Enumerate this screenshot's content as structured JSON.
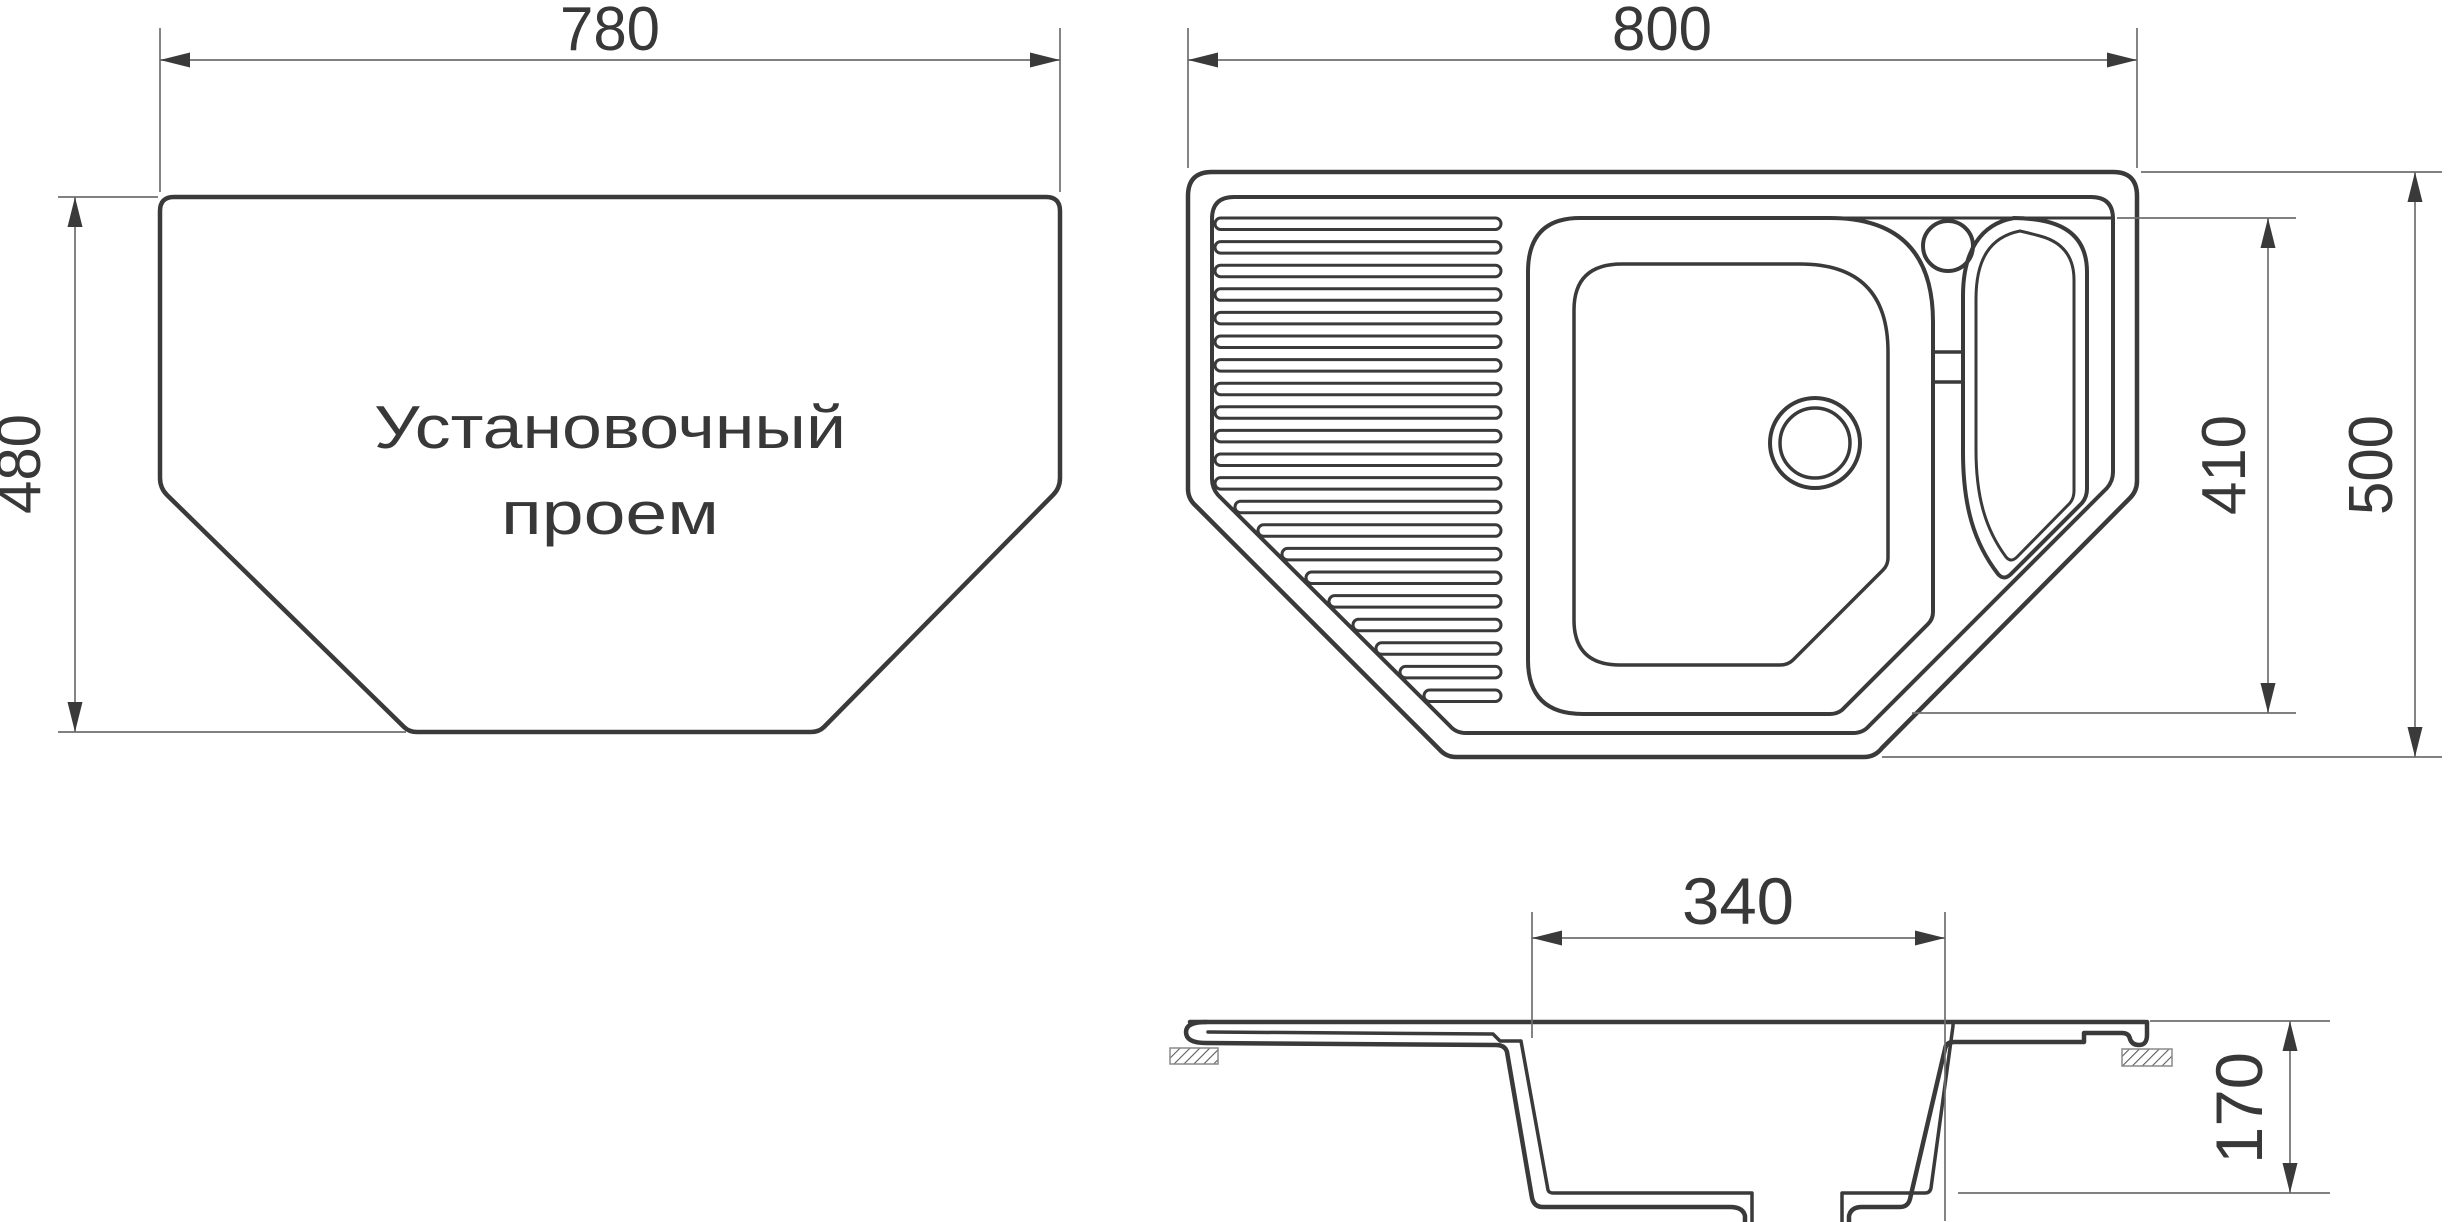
{
  "canvas": {
    "width": 2454,
    "height": 1222,
    "bg": "#ffffff"
  },
  "styles": {
    "line_color": "#3a3a3a",
    "thin_color": "#6f6f6f",
    "text_color": "#383838",
    "hatch_color": "#5c5c5c",
    "hatch_border": "#8a8a8a",
    "stroke_outer": 4.5,
    "stroke_inner": 3.5,
    "stroke_thin": 1.7
  },
  "views": {
    "opening_view": {
      "title_label": {
        "lines": [
          "Установочный",
          "проем"
        ],
        "x": 610,
        "ys": [
          448,
          534
        ],
        "font": 60,
        "text_lengths": [
          472,
          218
        ]
      },
      "elements": [
        {
          "kind": "path",
          "name": "opening-outline",
          "w": 4.5,
          "d": "M 174 197 L 1046 197 Q 1060 197 1060 211 L 1060 478 Q 1060 488 1053 495 L 824 727 Q 819 732 811 732 L 417 732 Q 409 732 404 727 L 167 495 Q 160 488 160 478 L 160 211 Q 160 197 174 197 Z"
        }
      ],
      "dimensions": [
        {
          "name": "dim-780",
          "value": "780",
          "font": 62,
          "text_length": 100,
          "text": {
            "x": 610,
            "y": 50
          },
          "line": [
            160,
            60,
            1060,
            60
          ],
          "ext": [
            [
              160,
              28,
              160,
              192
            ],
            [
              1060,
              28,
              1060,
              192
            ]
          ],
          "arrows": [
            {
              "x": 160,
              "y": 60,
              "dir": "left"
            },
            {
              "x": 1060,
              "y": 60,
              "dir": "right"
            }
          ]
        },
        {
          "name": "dim-480",
          "value": "480",
          "font": 62,
          "text_length": 100,
          "rotate": -90,
          "text": {
            "x": 40,
            "y": 464
          },
          "line": [
            75,
            197,
            75,
            732
          ],
          "ext": [
            [
              58,
              197,
              158,
              197
            ],
            [
              58,
              732,
              406,
              732
            ]
          ],
          "arrows": [
            {
              "x": 75,
              "y": 197,
              "dir": "up"
            },
            {
              "x": 75,
              "y": 732,
              "dir": "down"
            }
          ]
        }
      ]
    },
    "sink_top_view": {
      "elements": [
        {
          "kind": "path",
          "name": "sink-outer-outline",
          "w": 4.5,
          "d": "M 1212 172 L 2113 172 Q 2137 172 2137 196 L 2137 481 Q 2137 491 2130 498 L 1882 748 Q 1875 757 1864 757 L 1456 757 Q 1446 757 1439 749 L 1196 506 Q 1188 499 1188 489 L 1188 196 Q 1188 172 1212 172 Z"
        },
        {
          "kind": "path",
          "name": "sink-inner-rim",
          "w": 4,
          "d": "M 1234 197 L 2091 197 Q 2113 197 2113 219 L 2113 472 Q 2113 481 2107 488 L 1869 726 Q 1863 733 1853 733 L 1466 733 Q 1456 733 1450 726 L 1218 495 Q 1212 488 1212 479 L 1212 219 Q 1212 197 1234 197 Z"
        },
        {
          "kind": "line",
          "name": "faucet-deck-line",
          "w": 3,
          "pts": [
            1836,
            218,
            2113,
            218
          ]
        },
        {
          "kind": "path",
          "name": "main-bowl-outer",
          "w": 4,
          "d": "M 1580 218 L 1830 218 Q 1933 218 1933 322 L 1933 612 Q 1933 619 1928 624 L 1842 710 Q 1837 714 1830 714 L 1583 714 Q 1528 714 1528 660 L 1528 272 Q 1528 218 1580 218 Z"
        },
        {
          "kind": "path",
          "name": "main-bowl-inner",
          "w": 3.5,
          "d": "M 1622 264 L 1800 264 Q 1888 264 1888 352 L 1888 558 Q 1888 565 1883 570 L 1793 660 Q 1788 665 1780 665 L 1620 665 Q 1574 665 1574 620 L 1574 310 Q 1574 264 1622 264 Z"
        },
        {
          "kind": "circle",
          "name": "drain-hole-outer",
          "w": 4,
          "cx": 1815,
          "cy": 443,
          "r": 45
        },
        {
          "kind": "circle",
          "name": "drain-hole-inner",
          "w": 3.5,
          "cx": 1815,
          "cy": 443,
          "r": 35
        },
        {
          "kind": "path",
          "name": "small-bowl-outer",
          "w": 4,
          "d": "M 2014 218 C 1980 224 1963 252 1963 296 L 1963 452 C 1963 506 1974 543 1998 574 Q 2004 581 2011 574 L 2082 503 Q 2087 497 2087 489 L 2087 272 Q 2087 230 2044 221 Q 2028 218 2014 218 Z"
        },
        {
          "kind": "path",
          "name": "small-bowl-inner",
          "w": 3,
          "d": "M 2020 231 C 1990 237 1976 259 1976 299 L 1976 450 C 1976 498 1986 530 2006 557 Q 2011 563 2017 557 L 2070 503 Q 2074 498 2074 491 L 2074 280 Q 2074 245 2040 236 Q 2029 233 2020 231 Z"
        },
        {
          "kind": "line",
          "name": "overflow-channel-top",
          "w": 3.5,
          "pts": [
            1933,
            352,
            1963,
            352
          ]
        },
        {
          "kind": "line",
          "name": "overflow-channel-bottom",
          "w": 3.5,
          "pts": [
            1933,
            382,
            1963,
            382
          ]
        },
        {
          "kind": "circle",
          "name": "faucet-hole",
          "w": 4,
          "cx": 1948,
          "cy": 246,
          "r": 25
        }
      ],
      "ribs": {
        "name": "drainboard-rib",
        "right": 1501,
        "h": 11.5,
        "rx": 5.7,
        "w": 3,
        "bars": [
          {
            "x": 1215,
            "y": 218.0
          },
          {
            "x": 1215,
            "y": 241.6
          },
          {
            "x": 1215,
            "y": 265.2
          },
          {
            "x": 1215,
            "y": 288.8
          },
          {
            "x": 1215,
            "y": 312.4
          },
          {
            "x": 1215,
            "y": 336.0
          },
          {
            "x": 1215,
            "y": 359.6
          },
          {
            "x": 1215,
            "y": 383.2
          },
          {
            "x": 1215,
            "y": 406.8
          },
          {
            "x": 1215,
            "y": 430.4
          },
          {
            "x": 1215,
            "y": 454.0
          },
          {
            "x": 1215,
            "y": 477.6
          },
          {
            "x": 1235,
            "y": 501.2
          },
          {
            "x": 1258,
            "y": 524.8
          },
          {
            "x": 1282,
            "y": 548.4
          },
          {
            "x": 1306,
            "y": 572.0
          },
          {
            "x": 1329,
            "y": 595.6
          },
          {
            "x": 1353,
            "y": 619.2
          },
          {
            "x": 1376,
            "y": 642.8
          },
          {
            "x": 1400,
            "y": 666.4
          },
          {
            "x": 1424,
            "y": 690.0
          }
        ]
      },
      "dimensions": [
        {
          "name": "dim-800",
          "value": "800",
          "font": 62,
          "text_length": 100,
          "text": {
            "x": 1662,
            "y": 50
          },
          "line": [
            1188,
            60,
            2137,
            60
          ],
          "ext": [
            [
              1188,
              28,
              1188,
              168
            ],
            [
              2137,
              28,
              2137,
              168
            ]
          ],
          "arrows": [
            {
              "x": 1188,
              "y": 60,
              "dir": "left"
            },
            {
              "x": 2137,
              "y": 60,
              "dir": "right"
            }
          ]
        },
        {
          "name": "dim-500",
          "value": "500",
          "font": 62,
          "text_length": 100,
          "rotate": -90,
          "text": {
            "x": 2392,
            "y": 465
          },
          "line": [
            2415,
            172,
            2415,
            757
          ],
          "ext": [
            [
              2141,
              172,
              2442,
              172
            ],
            [
              1882,
              757,
              2442,
              757
            ]
          ],
          "arrows": [
            {
              "x": 2415,
              "y": 172,
              "dir": "up"
            },
            {
              "x": 2415,
              "y": 757,
              "dir": "down"
            }
          ]
        },
        {
          "name": "dim-410",
          "value": "410",
          "font": 62,
          "text_length": 100,
          "rotate": -90,
          "text": {
            "x": 2245,
            "y": 465
          },
          "line": [
            2268,
            218,
            2268,
            713
          ],
          "ext": [
            [
              2117,
              218,
              2296,
              218
            ],
            [
              1912,
              713,
              2296,
              713
            ]
          ],
          "arrows": [
            {
              "x": 2268,
              "y": 218,
              "dir": "up"
            },
            {
              "x": 2268,
              "y": 713,
              "dir": "down"
            }
          ]
        }
      ]
    },
    "section_view": {
      "elements": [
        {
          "kind": "path",
          "name": "section-top-surface",
          "w": 4.5,
          "d": "M 1190 1022 L 2145 1022"
        },
        {
          "kind": "path",
          "name": "section-outer-left-profile",
          "w": 4.5,
          "d": "M 1206 1022 Q 1186 1022 1186 1032 Q 1186 1043 1206 1043 L 1496 1045 Q 1505 1045 1507 1052 L 1532 1198 Q 1534 1207 1543 1207 L 1730 1207 Q 1743 1207 1745 1216 L 1745 1222"
        },
        {
          "kind": "path",
          "name": "section-outer-right-profile",
          "w": 4.5,
          "d": "M 1849 1222 L 1849 1216 Q 1851 1207 1862 1207 L 1900 1207 Q 1908 1207 1910 1199 L 1945 1049 Q 1946 1042 1954 1042 L 2084 1042 L 2084 1033 L 2122 1033 Q 2129 1033 2130 1039 Q 2132 1045 2139 1045 Q 2147 1045 2147 1035 L 2147 1022"
        },
        {
          "kind": "path",
          "name": "section-inner-left-profile",
          "w": 3.5,
          "d": "M 1208 1032 L 1493 1034 L 1500 1041 L 1521 1041 L 1548 1190 Q 1549 1193 1553 1193 L 1752 1193 L 1752 1222"
        },
        {
          "kind": "path",
          "name": "section-inner-right-profile",
          "w": 3.5,
          "d": "M 1842 1222 L 1842 1193 L 1925 1193 Q 1930 1193 1931 1188 L 1953 1026 L 1953 1022"
        },
        {
          "kind": "hatch",
          "name": "countertop-hatch-left",
          "x": 1170,
          "y": 1048,
          "wd": 48,
          "ht": 16
        },
        {
          "kind": "hatch",
          "name": "countertop-hatch-right",
          "x": 2122,
          "y": 1049,
          "wd": 50,
          "ht": 17
        }
      ],
      "dimensions": [
        {
          "name": "dim-340",
          "value": "340",
          "font": 66,
          "text_length": 112,
          "text": {
            "x": 1738,
            "y": 924
          },
          "line": [
            1532,
            938,
            1945,
            938
          ],
          "ext": [
            [
              1532,
              912,
              1532,
              1038
            ],
            [
              1945,
              912,
              1945,
              1221
            ]
          ],
          "arrows": [
            {
              "x": 1532,
              "y": 938,
              "dir": "left"
            },
            {
              "x": 1945,
              "y": 938,
              "dir": "right"
            }
          ]
        },
        {
          "name": "dim-170",
          "value": "170",
          "font": 66,
          "text_length": 112,
          "rotate": -90,
          "text": {
            "x": 2262,
            "y": 1108
          },
          "line": [
            2290,
            1021,
            2290,
            1193
          ],
          "ext": [
            [
              2150,
              1021,
              2330,
              1021
            ],
            [
              1958,
              1193,
              2330,
              1193
            ]
          ],
          "arrows": [
            {
              "x": 2290,
              "y": 1021,
              "dir": "up"
            },
            {
              "x": 2290,
              "y": 1193,
              "dir": "down"
            }
          ]
        }
      ]
    }
  }
}
